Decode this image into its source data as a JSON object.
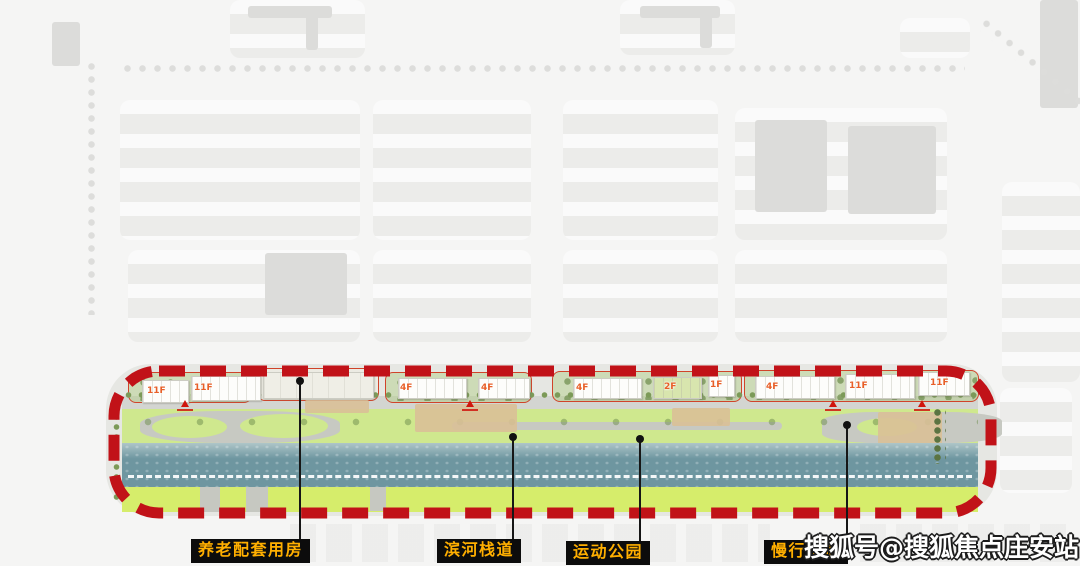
{
  "watermark": {
    "text": "搜狐号@搜狐焦点庄安站"
  },
  "callouts": [
    {
      "label": "养老配套用房",
      "dot": [
        300,
        381
      ],
      "box": [
        191,
        539
      ]
    },
    {
      "label": "滨河栈道",
      "dot": [
        513,
        437
      ],
      "box": [
        437,
        539
      ]
    },
    {
      "label": "运动公园",
      "dot": [
        640,
        439
      ],
      "box": [
        566,
        541
      ]
    },
    {
      "label": "慢行步道",
      "dot": [
        847,
        425
      ],
      "box": [
        764,
        540
      ]
    }
  ],
  "site": {
    "buildings": [
      {
        "label": "11F",
        "x": 142,
        "y": 380,
        "w": 45,
        "h": 21,
        "label_x": 147
      },
      {
        "label": "11F",
        "x": 191,
        "y": 376,
        "w": 68,
        "h": 23,
        "label_x": 194
      },
      {
        "label": "",
        "x": 263,
        "y": 372,
        "w": 109,
        "h": 25,
        "type": "pale"
      },
      {
        "label": "4F",
        "x": 398,
        "y": 378,
        "w": 67,
        "h": 19,
        "label_x": 400
      },
      {
        "label": "4F",
        "x": 478,
        "y": 378,
        "w": 50,
        "h": 19,
        "label_x": 481
      },
      {
        "label": "4F",
        "x": 573,
        "y": 378,
        "w": 67,
        "h": 19,
        "label_x": 576
      },
      {
        "label": "2F",
        "x": 653,
        "y": 377,
        "w": 47,
        "h": 20,
        "type": "green",
        "label_x": 664
      },
      {
        "label": "1F",
        "x": 708,
        "y": 375,
        "w": 25,
        "h": 20,
        "label_x": 710
      },
      {
        "label": "4F",
        "x": 755,
        "y": 376,
        "w": 78,
        "h": 21,
        "label_x": 766
      },
      {
        "label": "11F",
        "x": 845,
        "y": 374,
        "w": 68,
        "h": 23,
        "label_x": 849
      },
      {
        "label": "11F",
        "x": 918,
        "y": 372,
        "w": 50,
        "h": 22,
        "label_x": 930
      }
    ],
    "entrance_marker_xs": [
      185,
      470,
      833,
      922
    ]
  },
  "colors": {
    "boundary_red": "#c11218",
    "legend_bg": "#0c0c0c",
    "legend_text": "#ffaf00",
    "river": "#6e96a0",
    "lawn": "#d6ed6b",
    "park_green": "#cfe88e",
    "building_label": "#e85f28"
  }
}
